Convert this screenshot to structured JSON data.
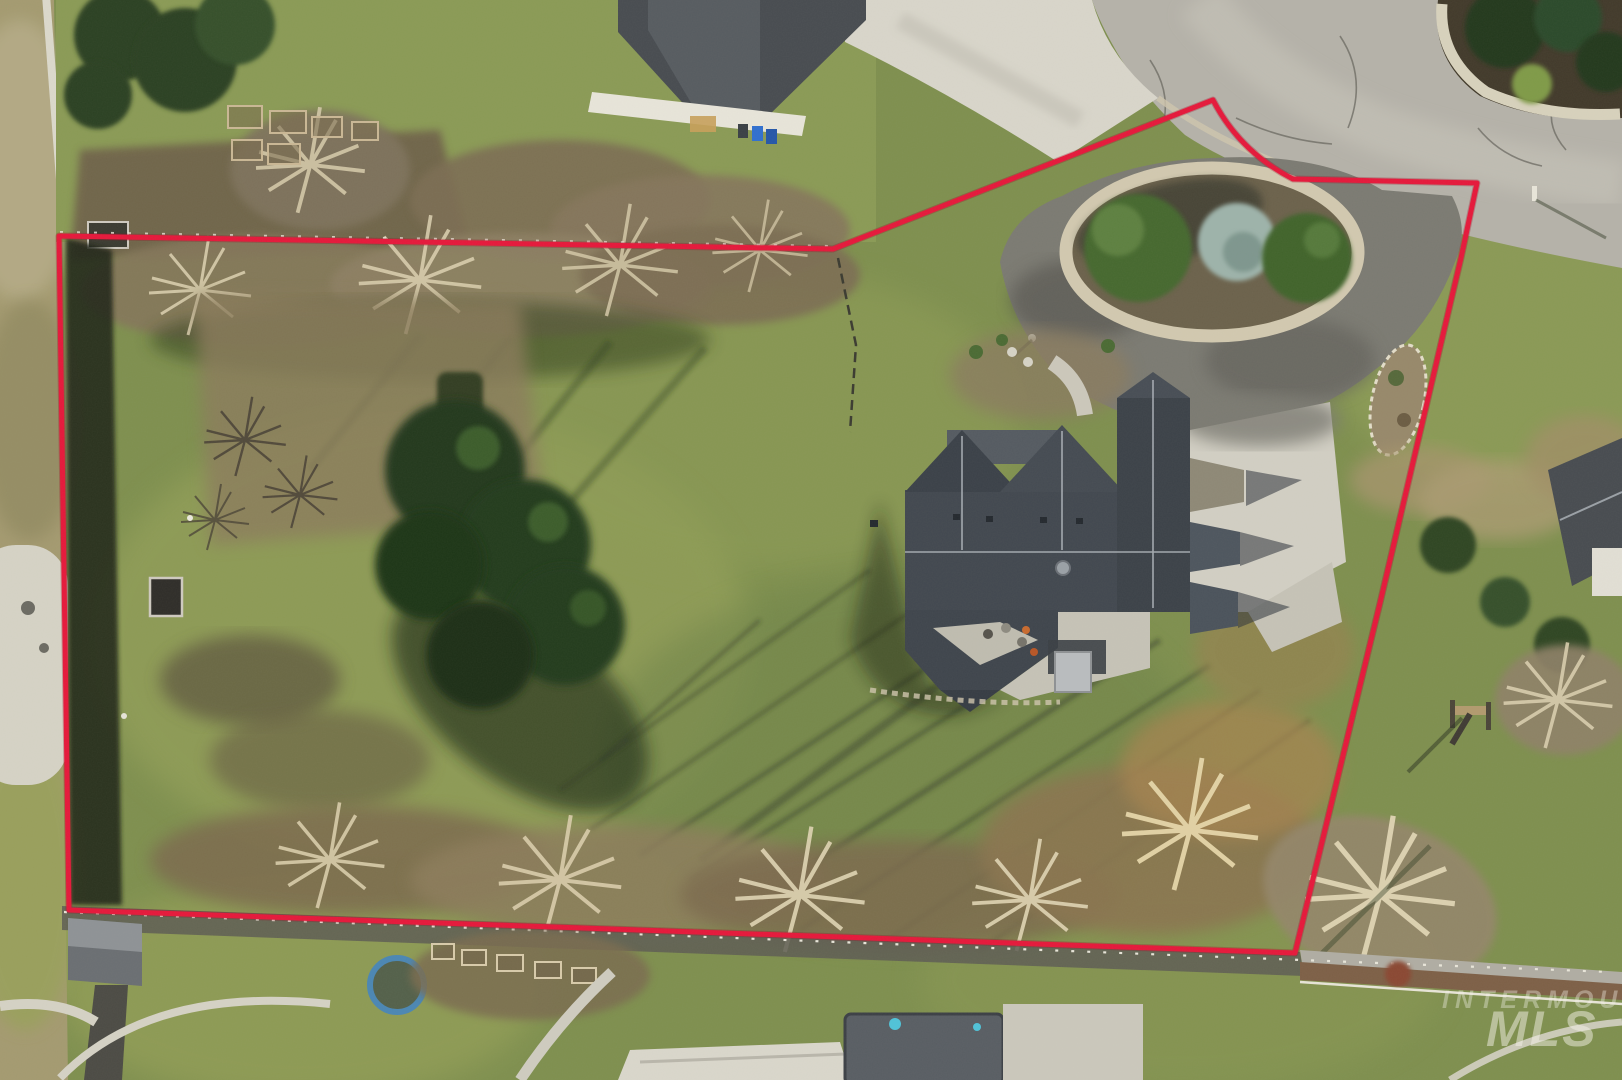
{
  "watermark": {
    "line1": "INTERMOUNTAIN",
    "line2": "MLS"
  },
  "colors": {
    "boundary_line": "#e6173a",
    "lawn": "#7e8f4e",
    "road_asphalt": "#b5b2a9",
    "driveway_asphalt": "#7b7a72",
    "concrete": "#d2cfc4",
    "house_roof": "#41474f",
    "evergreen": "#24371d",
    "scrub_grass": "#a49a70",
    "rock_border": "#d2c9b0",
    "pool_cover": "#585d63",
    "trampoline_ring": "#4a86b4"
  }
}
